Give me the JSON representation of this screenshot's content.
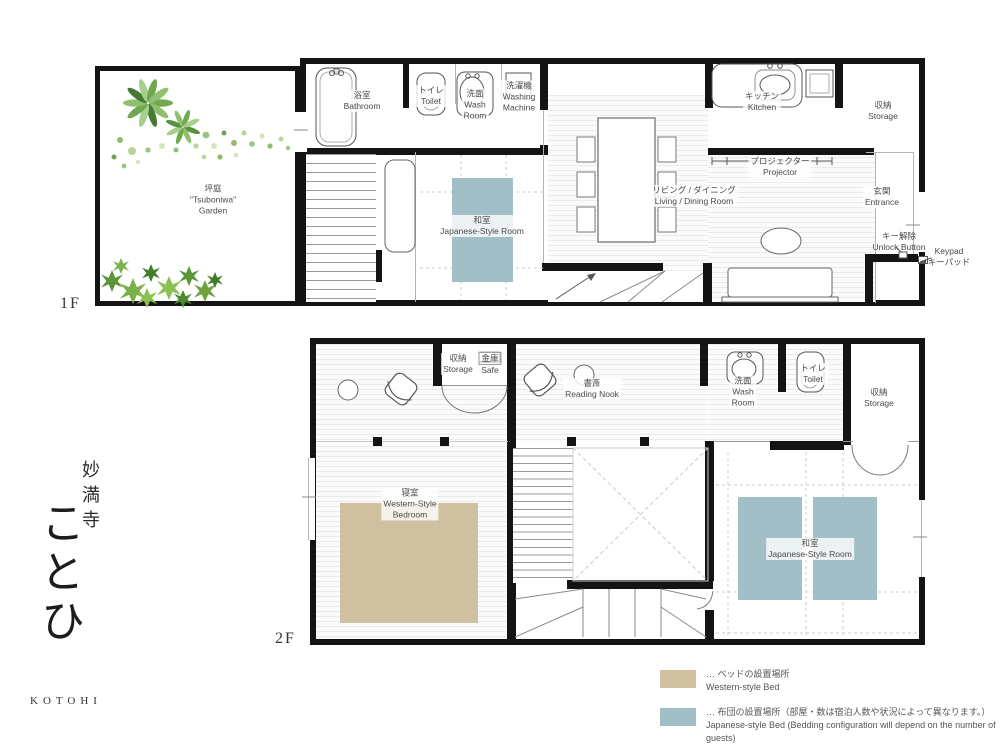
{
  "brand": {
    "temple": "妙満寺",
    "name": "ことひ",
    "roman": "KOTOHI"
  },
  "f1": {
    "floor_label": "1F",
    "garden_jp": "坪庭",
    "garden_en1": "\"Tsuboniwa\"",
    "garden_en2": "Garden",
    "bathroom_jp": "浴室",
    "bathroom_en": "Bathroom",
    "toilet_jp": "トイレ",
    "toilet_en": "Toilet",
    "wash_jp": "洗面",
    "wash_en1": "Wash",
    "wash_en2": "Room",
    "washing_jp": "洗濯機",
    "washing_en1": "Washing",
    "washing_en2": "Machine",
    "kitchen_jp": "キッチン",
    "kitchen_en": "Kitchen",
    "storage_jp": "収納",
    "storage_en": "Storage",
    "projector_jp": "プロジェクター",
    "projector_en": "Projector",
    "living_jp": "リビング / ダイニング",
    "living_en": "Living / Dining Room",
    "washitsu_jp": "和室",
    "washitsu_en": "Japanese-Style Room",
    "entrance_jp": "玄関",
    "entrance_en": "Entrance",
    "unlock_jp": "キー解除",
    "unlock_en": "Unlock Button",
    "keypad_en": "Keypad",
    "keypad_jp": "キーパッド"
  },
  "f2": {
    "floor_label": "2F",
    "storage_a_jp": "収納",
    "storage_a_en": "Storage",
    "safe_jp": "金庫",
    "safe_en": "Safe",
    "reading_jp": "書斎",
    "reading_en": "Reading Nook",
    "wash_jp": "洗面",
    "wash_en1": "Wash",
    "wash_en2": "Room",
    "toilet_jp": "トイレ",
    "toilet_en": "Toilet",
    "storage_b_jp": "収納",
    "storage_b_en": "Storage",
    "bedroom_jp": "寝室",
    "bedroom_en1": "Western-Style",
    "bedroom_en2": "Bedroom",
    "washitsu_jp": "和室",
    "washitsu_en": "Japanese-Style Room"
  },
  "legend": {
    "leader": "…",
    "western_jp": "ベッドの設置場所",
    "western_en": "Western-style Bed",
    "western_color": "#cfc0a0",
    "japanese_jp": "布団の設置場所（部屋・数は宿泊人数や状況によって異なります。）",
    "japanese_en": "Japanese-style Bed  (Bedding configuration will depend on the number of guests)",
    "japanese_color": "#a2bfc7"
  },
  "colors": {
    "wall": "#141414",
    "bed": "#cfc0a0",
    "futon": "#a2bfc7"
  }
}
